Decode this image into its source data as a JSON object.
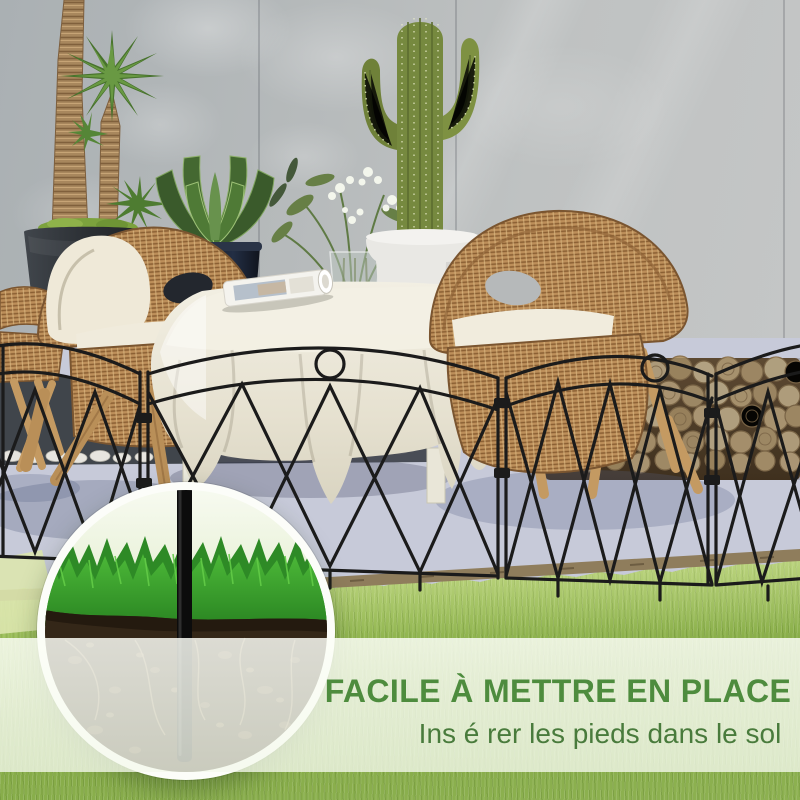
{
  "caption": {
    "title": "FACILE À METTRE EN PLACE",
    "subtitle": "Ins é rer les pieds dans le sol"
  },
  "palette": {
    "title_green": "#4e8c3e",
    "subtitle_green": "#497b3c",
    "fence_black": "#1b1b1b",
    "band_overlay": "rgba(250,253,245,0.8)",
    "lawn_green": "#8fb24c",
    "inset_grass_green": "#3fa332",
    "soil_brown": "#342718",
    "wall_gray": "#b7babb",
    "floor_lavender": "#c7cad9",
    "wicker_tan": "#bd8f5a",
    "cloth_cream": "#ece7d7",
    "cushion_white": "#f0ebdc",
    "stake_black": "#0c0c0c",
    "log_tan": "#c9b38f"
  },
  "scene_objects": {
    "inset_label": "ground stake cross-section",
    "fence_label": "black decorative garden fence"
  }
}
